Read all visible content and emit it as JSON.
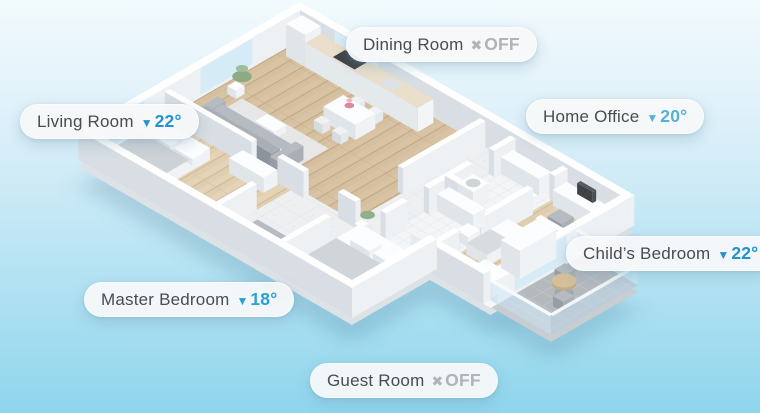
{
  "scene": {
    "description": "Isometric smart-home floor plan with per-room climate labels",
    "background_top": "#f2fafd",
    "background_bottom": "#8fd5ec"
  },
  "labels": [
    {
      "room": "Dining Room",
      "state": "off",
      "value": "OFF",
      "icon": "off-x-icon",
      "icon_glyph": "✖",
      "accent": "#b1b4b7"
    },
    {
      "room": "Living Room",
      "state": "cooling",
      "value": "22°",
      "icon": "triangle-down-icon",
      "icon_glyph": "▼",
      "accent": "#2493cf"
    },
    {
      "room": "Home Office",
      "state": "cooling",
      "value": "20°",
      "icon": "triangle-down-icon",
      "icon_glyph": "▼",
      "accent": "#58b0da"
    },
    {
      "room": "Child’s Bedroom",
      "state": "cooling",
      "value": "22°",
      "icon": "triangle-down-icon",
      "icon_glyph": "▼",
      "accent": "#2493cf"
    },
    {
      "room": "Master Bedroom",
      "state": "cooling",
      "value": "18°",
      "icon": "triangle-down-icon",
      "icon_glyph": "▼",
      "accent": "#2aa0d6"
    },
    {
      "room": "Guest Room",
      "state": "off",
      "value": "OFF",
      "icon": "off-x-icon",
      "icon_glyph": "✖",
      "accent": "#b1b4b7"
    }
  ],
  "rooms_in_plan": [
    "Kitchen / Dining",
    "Living Room",
    "Hallway",
    "Bathroom",
    "Bathroom 2",
    "Home Office",
    "Child’s Bedroom",
    "Master Bedroom",
    "Guest Room",
    "Balcony"
  ]
}
